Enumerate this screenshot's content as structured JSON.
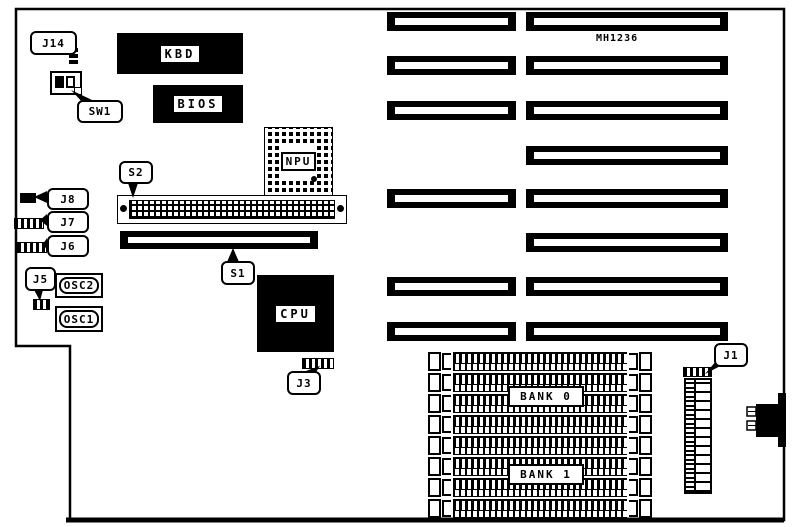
{
  "diagram": {
    "board_model": "MH1236",
    "callouts": {
      "j14": "J14",
      "sw1": "SW1",
      "j8": "J8",
      "j7": "J7",
      "j6": "J6",
      "j5": "J5",
      "s2": "S2",
      "s1": "S1",
      "j3": "J3",
      "j1": "J1"
    },
    "chips": {
      "kbd": "KBD",
      "bios": "BIOS",
      "npu": "NPU",
      "cpu": "CPU"
    },
    "oscillators": {
      "osc2": "OSC2",
      "osc1": "OSC1"
    },
    "memory": {
      "bank0": "BANK 0",
      "bank1": "BANK 1"
    }
  }
}
